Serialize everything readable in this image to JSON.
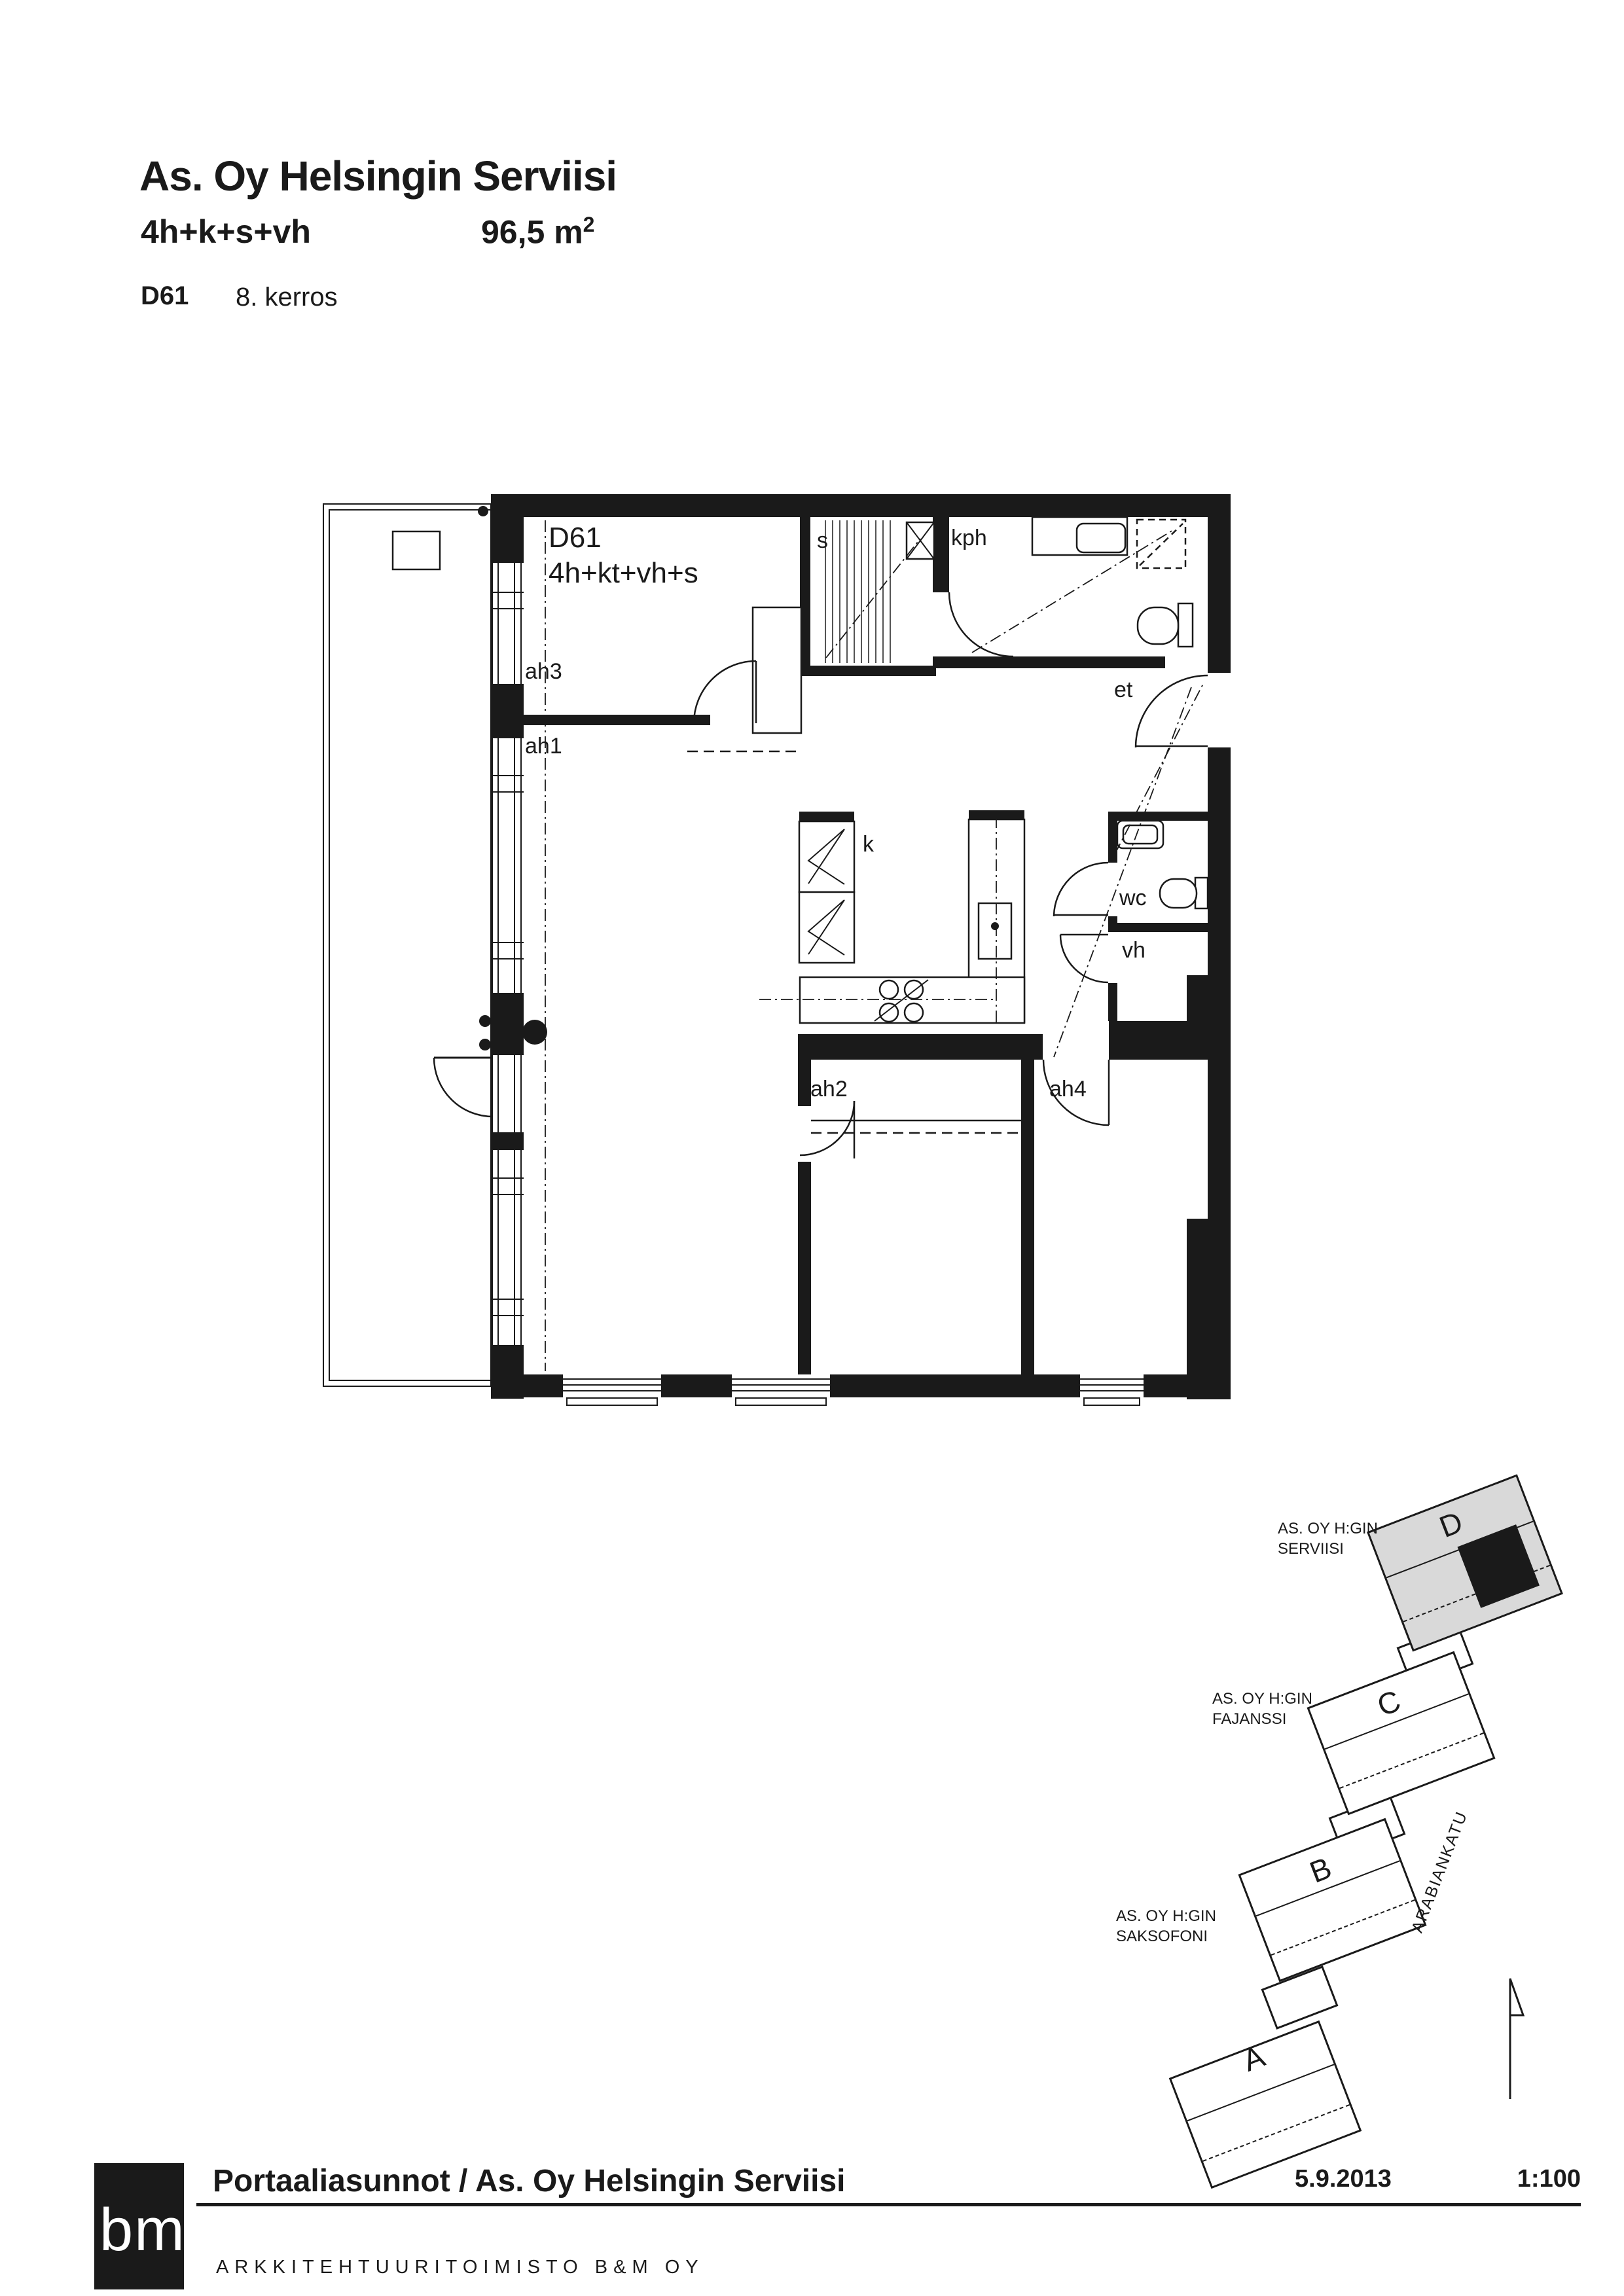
{
  "header": {
    "title": "As. Oy Helsingin Serviisi",
    "apartment_type": "4h+k+s+vh",
    "area_value": "96,5 m",
    "area_sup": "2",
    "unit_id": "D61",
    "floor": "8. kerros"
  },
  "floorplan": {
    "unit_label": "D61",
    "unit_type_label": "4h+kt+vh+s",
    "rooms": {
      "sauna": "s",
      "bathroom": "kph",
      "entry": "et",
      "kitchen": "k",
      "wc": "wc",
      "closet": "vh"
    },
    "ceiling_labels": {
      "ah1": "ah1",
      "ah2": "ah2",
      "ah3": "ah3",
      "ah4": "ah4"
    }
  },
  "siteplan": {
    "company_serviisi_line1": "AS. OY H:GIN",
    "company_serviisi_line2": "SERVIISI",
    "company_fajanssi_line1": "AS. OY H:GIN",
    "company_fajanssi_line2": "FAJANSSI",
    "company_saksofoni_line1": "AS. OY H:GIN",
    "company_saksofoni_line2": "SAKSOFONI",
    "street": "ARABIANKATU",
    "building_d": "D",
    "building_c": "C",
    "building_b": "B",
    "building_a": "A",
    "highlight_color": "#1a1a1a",
    "building_d_fill": "#d9d9d9"
  },
  "footer": {
    "logo_text": "bm",
    "project_title": "Portaaliasunnot / As. Oy Helsingin Serviisi",
    "office": "ARKKITEHTUURITOIMISTO  B&M  OY",
    "date": "5.9.2013",
    "scale": "1:100"
  }
}
